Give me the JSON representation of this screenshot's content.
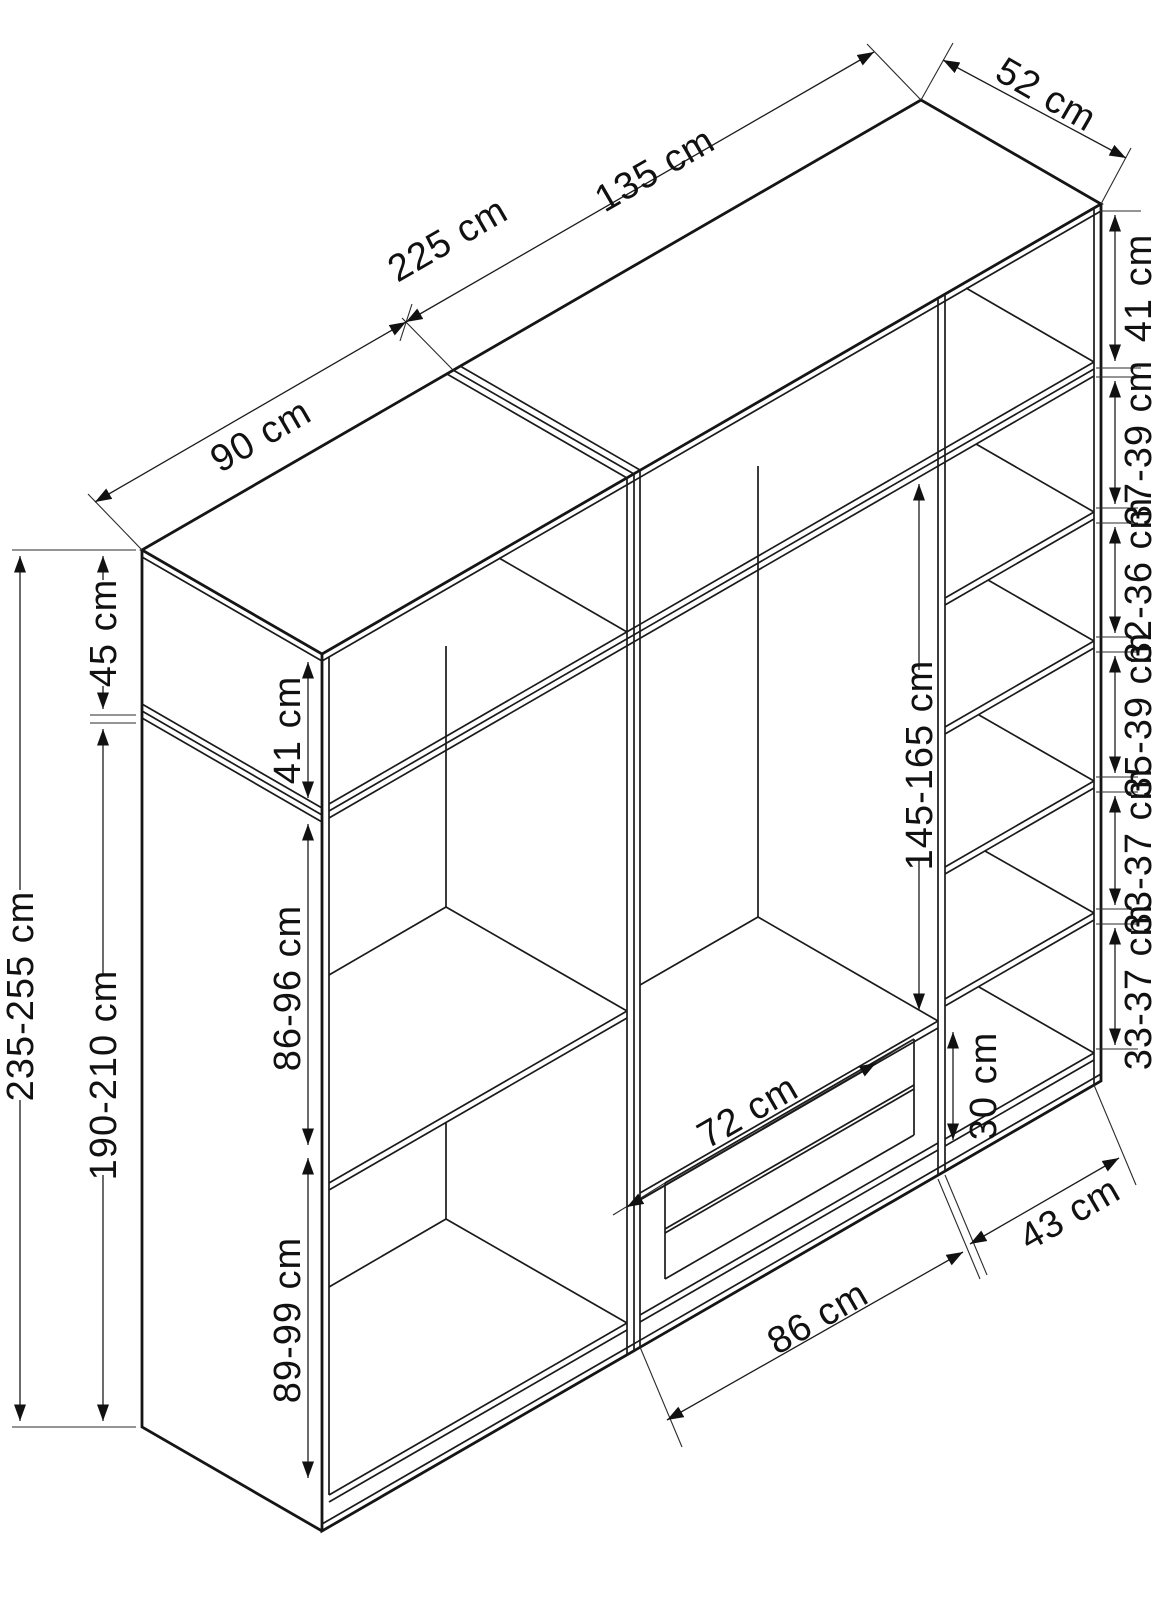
{
  "title": "Wardrobe isometric dimension drawing",
  "unit": "cm",
  "dims": {
    "total_width": "225 cm",
    "left_width": "90 cm",
    "right_width": "135 cm",
    "depth": "52 cm",
    "top_box_inner_right": "41 cm",
    "right_sections": [
      "37-39 cm",
      "32-36 cm",
      "35-39 cm",
      "33-37 cm",
      "33-37 cm"
    ],
    "right_col_width": "43 cm",
    "total_height": "235-255 cm",
    "top_box_height": "45 cm",
    "top_box_inner_left": "41 cm",
    "body_height": "190-210 cm",
    "left_upper_section": "86-96 cm",
    "left_lower_section": "89-99 cm",
    "hanging_height": "145-165 cm",
    "drawer_width": "72 cm",
    "drawer_stack_height": "30 cm",
    "mid_col_width": "86 cm"
  }
}
